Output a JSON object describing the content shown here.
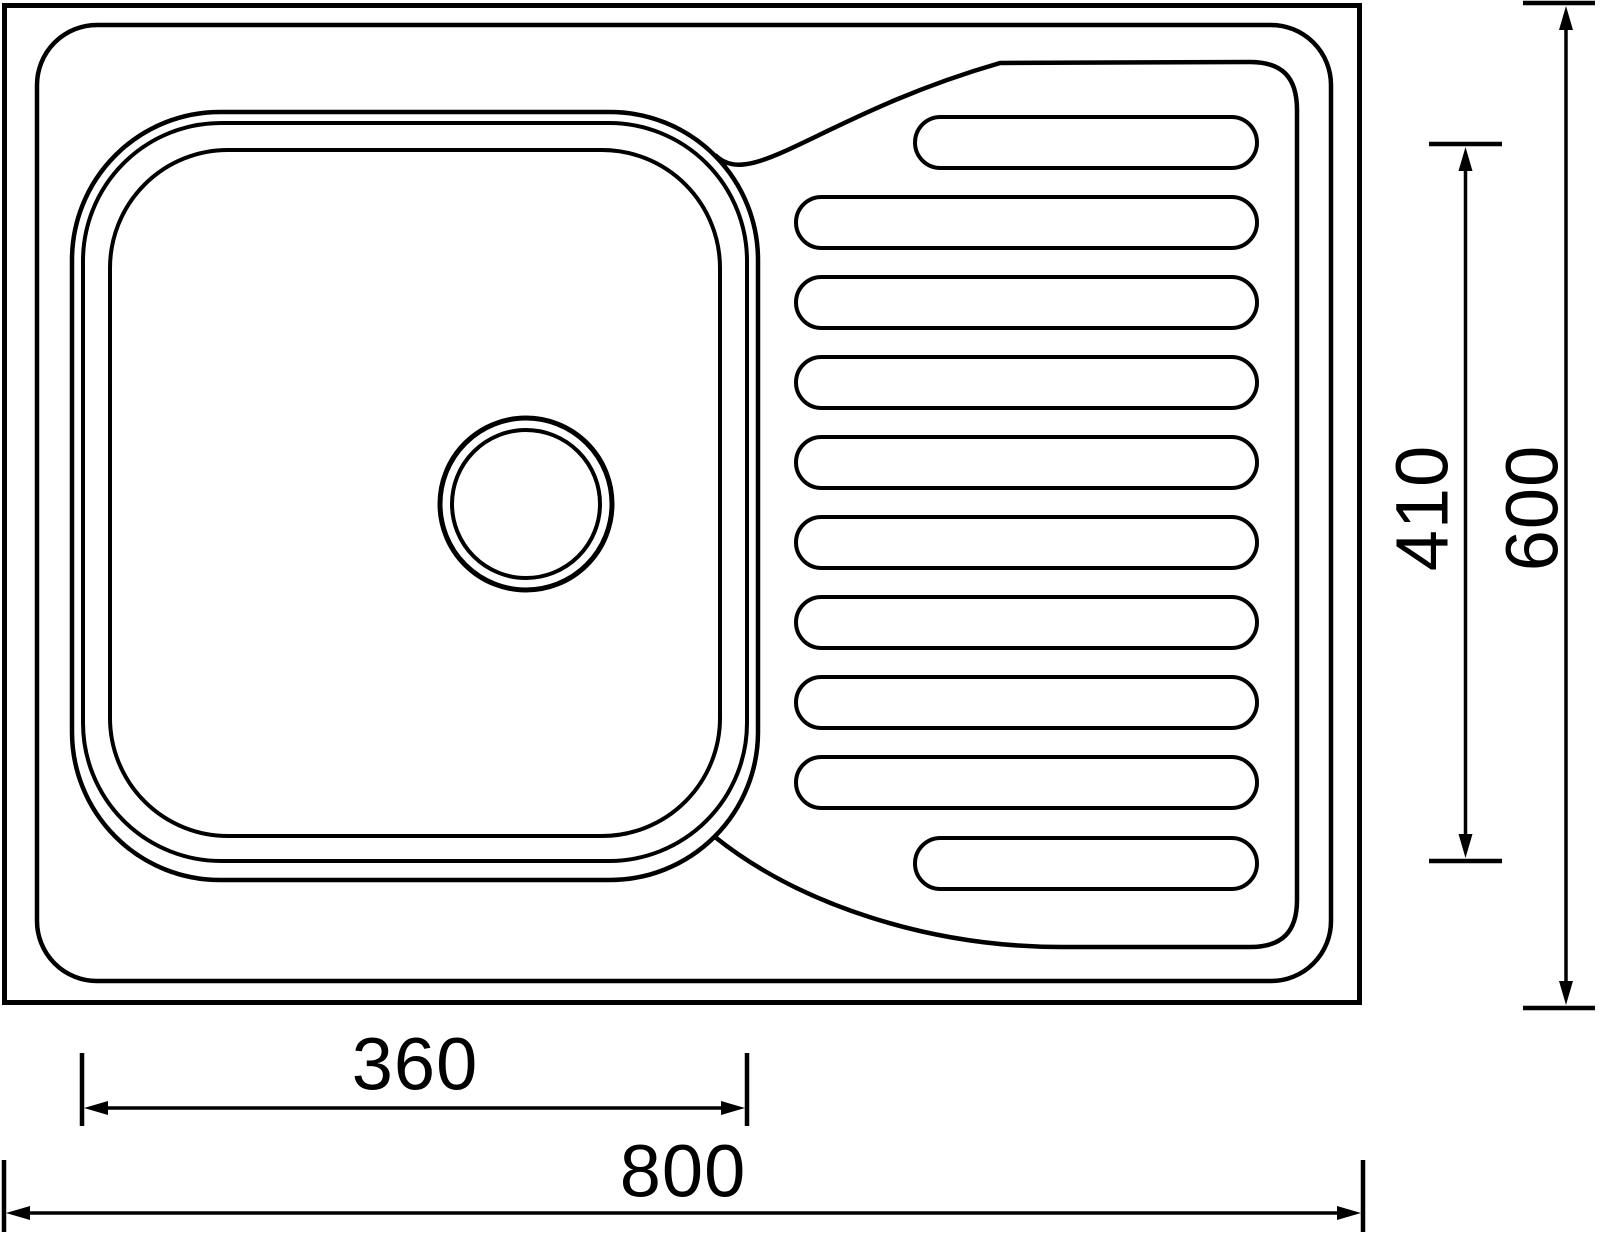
{
  "page": {
    "background": "#ffffff",
    "drawing_color": "#000000"
  },
  "diagram": {
    "type": "technical-drawing-top-view",
    "subject": "single-bowl kitchen sink with right-hand ribbed drainer",
    "features": {
      "bowl": "rounded-square bowl with triple contour lines and circular drain hole",
      "drain": "double-ring circular drain opening",
      "drainer": "draining board with rounded rib grooves",
      "rib_count": 10
    },
    "dimensions": {
      "bowl_width": {
        "label": "360",
        "value_mm": 360,
        "orientation": "horizontal",
        "measures": "bowl inner width"
      },
      "overall_width": {
        "label": "800",
        "value_mm": 800,
        "orientation": "horizontal",
        "measures": "overall sink width"
      },
      "drainer_span": {
        "label": "410",
        "value_mm": 410,
        "orientation": "vertical",
        "measures": "drainer rib field length"
      },
      "overall_depth": {
        "label": "600",
        "value_mm": 600,
        "orientation": "vertical",
        "measures": "overall sink depth"
      }
    }
  }
}
